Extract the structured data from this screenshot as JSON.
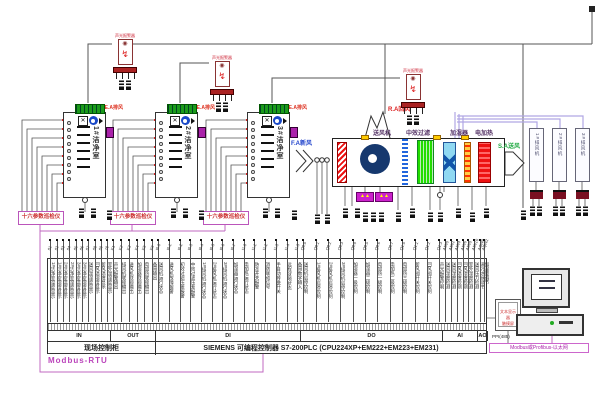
{
  "alarms": {
    "label": "声光报警器"
  },
  "cleanrooms": [
    {
      "name": "1#洁净室",
      "exhaust": "E.A排风"
    },
    {
      "name": "2#洁净室",
      "exhaust": "E.A排风"
    },
    {
      "name": "3#洁净室",
      "exhaust": "E.A排风"
    }
  ],
  "monitors": {
    "label": "十六参数巡检仪"
  },
  "ahu": {
    "return_air_label": "R.A回风",
    "fresh_air_label": "F.A新风",
    "supply_air_label": "S.A送风",
    "fan_label": "送风机",
    "filter_label": "中效过滤",
    "humidifier_label": "加湿器",
    "heater_label": "电加热"
  },
  "duct_fans": [
    {
      "name": "1#排风机"
    },
    {
      "name": "2#排风机"
    },
    {
      "name": "3#排风机"
    }
  ],
  "io_panel": {
    "cabinet_label": "现场控制柜",
    "plc_label": "SIEMENS  可编程控制器 S7-200PLC (CPU224XP+EM222+EM223+EM231)",
    "sections": [
      {
        "name": "IN",
        "wires": [
          {
            "addr": "01",
            "label": "1#洁净室温度显示"
          },
          {
            "addr": "02",
            "label": "1#洁净室湿度显示"
          },
          {
            "addr": "03",
            "label": "2#洁净室温度显示"
          },
          {
            "addr": "04",
            "label": "2#洁净室湿度显示"
          },
          {
            "addr": "05",
            "label": "3#洁净室温度显示"
          },
          {
            "addr": "06",
            "label": "3#洁净室湿度显示"
          },
          {
            "addr": "07",
            "label": "送风温湿度显示"
          },
          {
            "addr": "08",
            "label": "回风温湿度显示"
          },
          {
            "addr": "09",
            "label": "新风温度显示"
          },
          {
            "addr": "10",
            "label": "室外温湿度显示"
          }
        ]
      },
      {
        "name": "OUT",
        "wires": [
          {
            "addr": "K1",
            "label": "声光报警输出"
          },
          {
            "addr": "K2",
            "label": "排风机联锁输出"
          },
          {
            "addr": "K3",
            "label": "送风机联锁输出"
          },
          {
            "addr": "K4",
            "label": "加湿器联锁输出"
          },
          {
            "addr": "K5",
            "label": "电加热联锁输出"
          },
          {
            "addr": "K6",
            "label": "备用输出"
          }
        ]
      },
      {
        "name": "DI",
        "wires": [
          {
            "addr": "I0.0",
            "label": "送风机运行状态"
          },
          {
            "addr": "I0.1",
            "label": "送风机故障报警"
          },
          {
            "addr": "I0.2",
            "label": "初效过滤压差报警"
          },
          {
            "addr": "I0.3",
            "label": "中效过滤压差报警"
          },
          {
            "addr": "I0.4",
            "label": "1#排风机运行状态"
          },
          {
            "addr": "I0.5",
            "label": "2#排风机运行状态"
          },
          {
            "addr": "I0.6",
            "label": "3#排风机运行状态"
          },
          {
            "addr": "I0.7",
            "label": "加湿器运行状态"
          },
          {
            "addr": "I1.0",
            "label": "电加热运行状态"
          },
          {
            "addr": "I1.1",
            "label": "防冻开关报警"
          },
          {
            "addr": "I1.2",
            "label": "消防联动信号"
          },
          {
            "addr": "I1.3",
            "label": "手自动转换开关"
          },
          {
            "addr": "I1.4",
            "label": "远程/就地状态"
          },
          {
            "addr": "I1.5",
            "label": "备用数字输入"
          }
        ]
      },
      {
        "name": "DO",
        "wires": [
          {
            "addr": "Q0.0",
            "label": "送风机启停控制"
          },
          {
            "addr": "Q0.1",
            "label": "1#排风机启停控制"
          },
          {
            "addr": "Q0.2",
            "label": "2#排风机启停控制"
          },
          {
            "addr": "Q0.3",
            "label": "3#排风机启停控制"
          },
          {
            "addr": "Q0.4",
            "label": "加湿器一级控制"
          },
          {
            "addr": "Q0.5",
            "label": "加湿器二级控制"
          },
          {
            "addr": "Q0.6",
            "label": "电加热一级控制"
          },
          {
            "addr": "Q0.7",
            "label": "电加热二级控制"
          },
          {
            "addr": "Q1.0",
            "label": "电加热三级控制"
          },
          {
            "addr": "Q1.1",
            "label": "新风阀开关控制"
          },
          {
            "addr": "Q1.2",
            "label": "回风阀开关控制"
          },
          {
            "addr": "Q1.3",
            "label": "声光报警控制"
          }
        ]
      },
      {
        "name": "AI",
        "wires": [
          {
            "addr": "AIW0",
            "label": "送风温度检测"
          },
          {
            "addr": "AIW2",
            "label": "送风湿度检测"
          },
          {
            "addr": "AIW4",
            "label": "回风温度检测"
          },
          {
            "addr": "AIW6",
            "label": "回风湿度检测"
          },
          {
            "addr": "AIW8",
            "label": "室外温度检测"
          },
          {
            "addr": "AIW10",
            "label": "送风压力检测"
          }
        ]
      },
      {
        "name": "AO",
        "wires": [
          {
            "addr": "AQW0",
            "label": "表冷水阀调节"
          },
          {
            "addr": "AQW2",
            "label": "加湿量调节"
          }
        ]
      }
    ]
  },
  "bus": {
    "modbus_label": "Modbus-RTU",
    "ppi_label": "PPI(485)",
    "fieldbus_label": "Modbus或Profibus-以太网"
  },
  "hmi": {
    "display_line1": "文本显示器",
    "display_line2": "触摸屏"
  }
}
